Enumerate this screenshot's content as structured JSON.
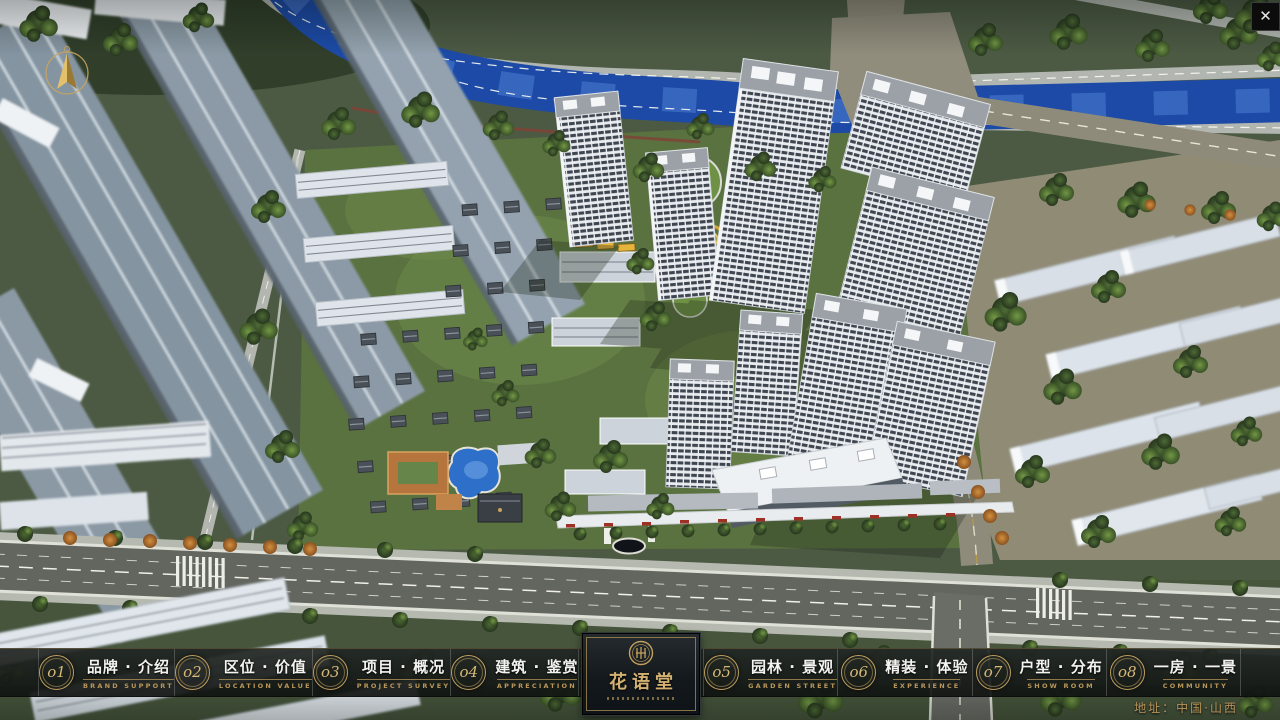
{
  "window": {
    "close_glyph": "✕"
  },
  "nav": {
    "items": [
      {
        "num": "o1",
        "label": "品牌 · 介绍",
        "sub": "BRAND SUPPORT"
      },
      {
        "num": "o2",
        "label": "区位 · 价值",
        "sub": "LOCATION VALUE"
      },
      {
        "num": "o3",
        "label": "项目 · 概况",
        "sub": "PROJECT SURVEY"
      },
      {
        "num": "o4",
        "label": "建筑 · 鉴赏",
        "sub": "APPRECIATION"
      },
      {
        "num": "o5",
        "label": "园林 · 景观",
        "sub": "GARDEN STREET"
      },
      {
        "num": "o6",
        "label": "精装 · 体验",
        "sub": "EXPERIENCE"
      },
      {
        "num": "o7",
        "label": "户型 · 分布",
        "sub": "SHOW ROOM"
      },
      {
        "num": "o8",
        "label": "一房 · 一景",
        "sub": "COMMUNITY"
      }
    ],
    "logo": {
      "title": "花语堂"
    },
    "address": "地址：中国·山西"
  },
  "colors": {
    "accent_gold": "#c3a05e",
    "bar_background": "rgba(22,25,23,0.9)",
    "river_blue": "#1c4aa6",
    "lawn_green": "#5a7140"
  }
}
